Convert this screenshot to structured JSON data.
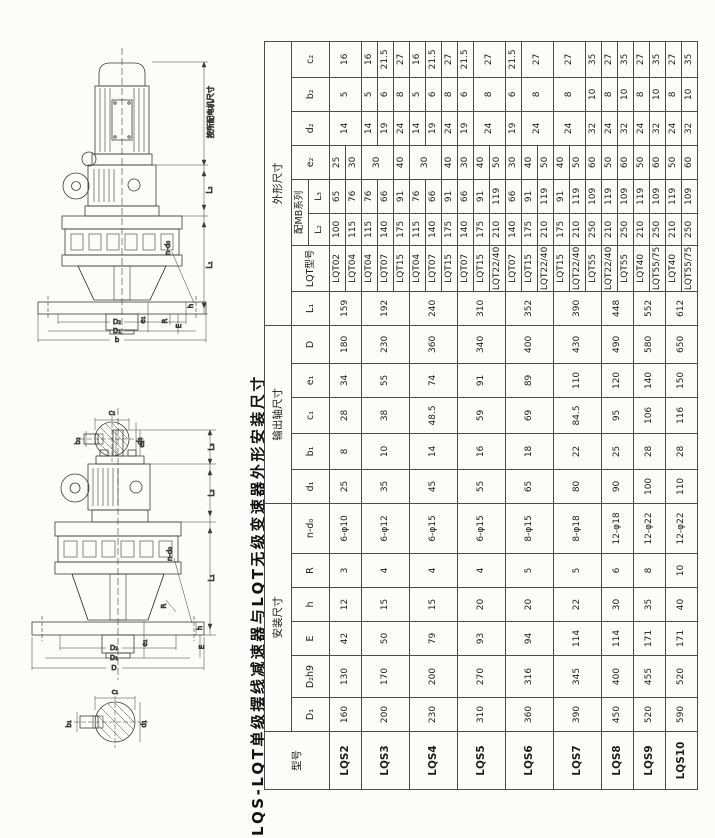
{
  "title": "LQS-LQT单级摆线减速器与LQT无级变速器外形安装尺寸",
  "headers": {
    "model": "型号",
    "sections": [
      "安装尺寸",
      "输出轴尺寸",
      "外形尺寸"
    ],
    "install_cols": [
      "D₁",
      "D₂h9",
      "E",
      "h",
      "R",
      "n-d₀"
    ],
    "shaft_cols": [
      "d₁",
      "b₁",
      "c₁",
      "e₁",
      "D"
    ],
    "outline_cols_a": [
      "L₁",
      "LQT型号"
    ],
    "mb_series": "配MB系列",
    "mb_cols": [
      "L₂",
      "L₃"
    ],
    "outline_cols_b": [
      "e₂",
      "d₂",
      "b₂",
      "c₂"
    ]
  },
  "col_widths": [
    58,
    34,
    42,
    34,
    34,
    34,
    50,
    34,
    36,
    36,
    34,
    38,
    34,
    46,
    32,
    34,
    34,
    34,
    34,
    36
  ],
  "groups": [
    {
      "model": "LQS2",
      "D1": "160",
      "D2h9": "130",
      "E": "42",
      "h": "12",
      "R": "3",
      "n_d0": "6-φ10",
      "d1": "25",
      "b1": "8",
      "c1": "28",
      "e1": "34",
      "D": "180",
      "L1": "159",
      "variants": [
        [
          "LQT02",
          "100",
          "65",
          "25",
          "14",
          "5",
          "16"
        ],
        [
          "LQT04",
          "115",
          "76",
          "30",
          null,
          null,
          null
        ]
      ]
    },
    {
      "model": "LQS3",
      "D1": "200",
      "D2h9": "170",
      "E": "50",
      "h": "15",
      "R": "4",
      "n_d0": "6-φ12",
      "d1": "35",
      "b1": "10",
      "c1": "38",
      "e1": "55",
      "D": "230",
      "L1": "192",
      "variants": [
        [
          "LQT04",
          "115",
          "76",
          "30",
          "14",
          "5",
          "16"
        ],
        [
          "LQT07",
          "140",
          "66",
          null,
          "19",
          "6",
          "21.5"
        ],
        [
          "LQT15",
          "175",
          "91",
          "40",
          "24",
          "8",
          "27"
        ]
      ]
    },
    {
      "model": "LQS4",
      "D1": "230",
      "D2h9": "200",
      "E": "79",
      "h": "15",
      "R": "4",
      "n_d0": "6-φ15",
      "d1": "45",
      "b1": "14",
      "c1": "48.5",
      "e1": "74",
      "D": "360",
      "L1": "240",
      "variants": [
        [
          "LQT04",
          "115",
          "76",
          "30",
          "14",
          "5",
          "16"
        ],
        [
          "LQT07",
          "140",
          "66",
          null,
          "19",
          "6",
          "21.5"
        ],
        [
          "LQT15",
          "175",
          "91",
          "40",
          "24",
          "8",
          "27"
        ]
      ]
    },
    {
      "model": "LQS5",
      "D1": "310",
      "D2h9": "270",
      "E": "93",
      "h": "20",
      "R": "4",
      "n_d0": "6-φ15",
      "d1": "55",
      "b1": "16",
      "c1": "59",
      "e1": "91",
      "D": "340",
      "L1": "310",
      "variants": [
        [
          "LQT07",
          "140",
          "66",
          "30",
          "19",
          "6",
          "21.5"
        ],
        [
          "LQT15",
          "175",
          "91",
          "40",
          "24",
          "8",
          "27"
        ],
        [
          "LQT22/40",
          "210",
          "119",
          "50",
          null,
          null,
          null
        ]
      ]
    },
    {
      "model": "LQS6",
      "D1": "360",
      "D2h9": "316",
      "E": "94",
      "h": "20",
      "R": "5",
      "n_d0": "8-φ15",
      "d1": "65",
      "b1": "18",
      "c1": "69",
      "e1": "89",
      "D": "400",
      "L1": "352",
      "variants": [
        [
          "LQT07",
          "140",
          "66",
          "30",
          "19",
          "6",
          "21.5"
        ],
        [
          "LQT15",
          "175",
          "91",
          "40",
          "24",
          "8",
          "27"
        ],
        [
          "LQT22/40",
          "210",
          "119",
          "50",
          null,
          null,
          null
        ]
      ]
    },
    {
      "model": "LQS7",
      "D1": "390",
      "D2h9": "345",
      "E": "114",
      "h": "22",
      "R": "5",
      "n_d0": "8-φ18",
      "d1": "80",
      "b1": "22",
      "c1": "84.5",
      "e1": "110",
      "D": "430",
      "L1": "390",
      "variants": [
        [
          "LQT15",
          "175",
          "91",
          "40",
          "24",
          "8",
          "27"
        ],
        [
          "LQT22/40",
          "210",
          "119",
          "50",
          null,
          null,
          null
        ],
        [
          "LQT55",
          "250",
          "109",
          "60",
          "32",
          "10",
          "35"
        ]
      ]
    },
    {
      "model": "LQS8",
      "D1": "450",
      "D2h9": "400",
      "E": "114",
      "h": "30",
      "R": "6",
      "n_d0": "12-φ18",
      "d1": "90",
      "b1": "25",
      "c1": "95",
      "e1": "120",
      "D": "490",
      "L1": "448",
      "variants": [
        [
          "LQT22/40",
          "210",
          "119",
          "50",
          "24",
          "8",
          "27"
        ],
        [
          "LQT55",
          "250",
          "109",
          "60",
          "32",
          "10",
          "35"
        ]
      ]
    },
    {
      "model": "LQS9",
      "D1": "520",
      "D2h9": "455",
      "E": "171",
      "h": "35",
      "R": "8",
      "n_d0": "12-φ22",
      "d1": "100",
      "b1": "28",
      "c1": "106",
      "e1": "140",
      "D": "580",
      "L1": "552",
      "variants": [
        [
          "LQT40",
          "210",
          "119",
          "50",
          "24",
          "8",
          "27"
        ],
        [
          "LQT55/75",
          "250",
          "109",
          "60",
          "32",
          "10",
          "35"
        ]
      ]
    },
    {
      "model": "LQS10",
      "D1": "590",
      "D2h9": "520",
      "E": "171",
      "h": "40",
      "R": "10",
      "n_d0": "12-φ22",
      "d1": "110",
      "b1": "28",
      "c1": "116",
      "e1": "150",
      "D": "650",
      "L1": "612",
      "variants": [
        [
          "LQT40",
          "210",
          "119",
          "50",
          "24",
          "8",
          "27"
        ],
        [
          "LQT55/75",
          "250",
          "109",
          "60",
          "32",
          "10",
          "35"
        ]
      ]
    }
  ],
  "dim_labels": {
    "motor_note": "按所配电机尺寸",
    "L1": "L₁",
    "L2": "L₂",
    "L3": "L₃",
    "e1": "e₁",
    "e2": "e₂",
    "n_d0": "n-d₀",
    "h": "h",
    "R": "R",
    "E": "E",
    "b": "b",
    "D": "D",
    "D1": "D₁",
    "D2": "D₂",
    "c1": "c₁",
    "b1": "b₁",
    "d1": "d₁",
    "c2": "c₂",
    "b2": "b₂",
    "d2": "d₂"
  }
}
